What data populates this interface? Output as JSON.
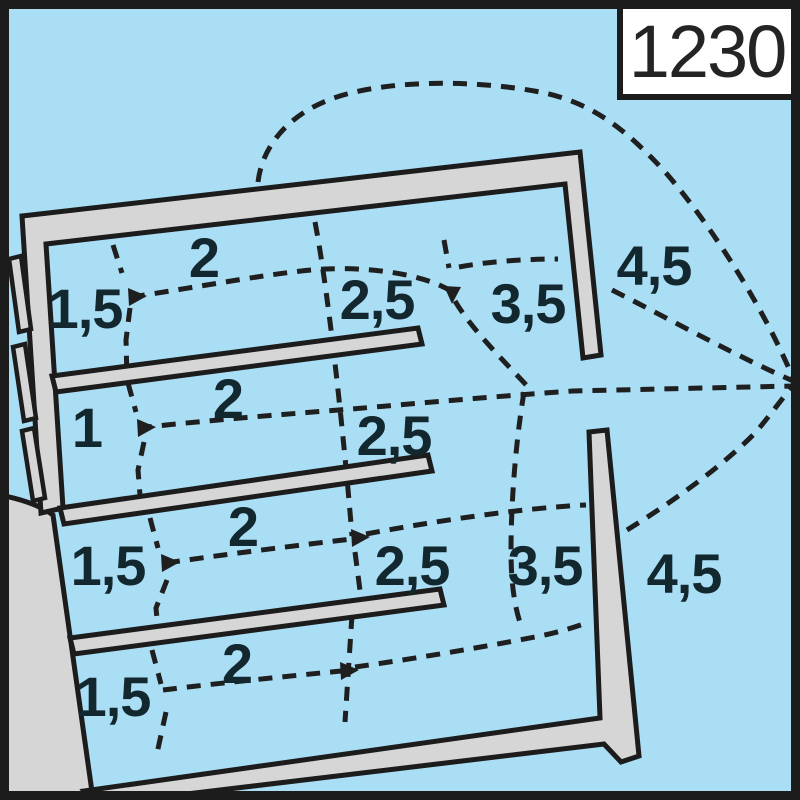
{
  "chart_number": "1230",
  "depth_labels": [
    {
      "area": "basin-1-inner",
      "text": "1,5"
    },
    {
      "area": "basin-1-mid",
      "text": "2"
    },
    {
      "area": "basin-1-outer",
      "text": "2,5"
    },
    {
      "area": "basin-1-mouth",
      "text": "3,5"
    },
    {
      "area": "outer-right-upper",
      "text": "4,5"
    },
    {
      "area": "basin-2-inner",
      "text": "1"
    },
    {
      "area": "basin-2-mid",
      "text": "2"
    },
    {
      "area": "basin-2-outer",
      "text": "2,5"
    },
    {
      "area": "basin-3-inner",
      "text": "1,5"
    },
    {
      "area": "basin-3-mid",
      "text": "2"
    },
    {
      "area": "basin-3-outer",
      "text": "2,5"
    },
    {
      "area": "basin-3-mouth",
      "text": "3,5"
    },
    {
      "area": "outer-right-lower",
      "text": "4,5"
    },
    {
      "area": "basin-4-inner",
      "text": "1,5"
    },
    {
      "area": "basin-4-mid",
      "text": "2"
    }
  ],
  "colors": {
    "water": "#a9def5",
    "structure": "#d6d6d6",
    "outline": "#1c1c1c",
    "contour": "#1f1f1f",
    "label": "#13272f",
    "box_bg": "#ffffff"
  }
}
